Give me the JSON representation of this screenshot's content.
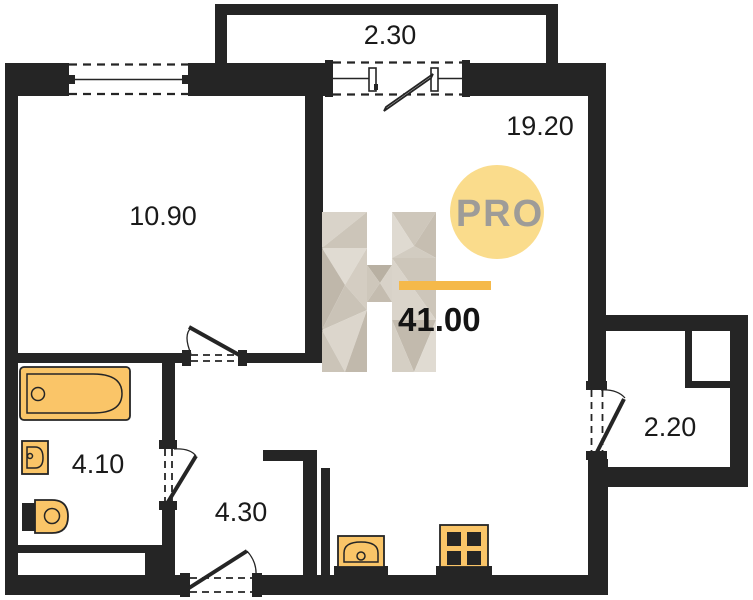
{
  "watermark": {
    "letter": "H",
    "badge": "PRO"
  },
  "areas": {
    "total": "41.00",
    "balcony_top": "2.30",
    "room_left": "10.90",
    "room_right": "19.20",
    "bathroom": "4.10",
    "hallway": "4.30",
    "balcony_right": "2.20"
  },
  "colors": {
    "wall": "#252525",
    "fixture": "#FAC568",
    "accent_bar": "#F5B94A",
    "badge_fill": "#FADC8C",
    "badge_text": "#9E9C98",
    "label_text": "#1A1A1A"
  },
  "icons": [
    "bathtub-icon",
    "washbasin-icon",
    "toilet-icon",
    "kitchen-sink-icon",
    "stove-icon"
  ]
}
